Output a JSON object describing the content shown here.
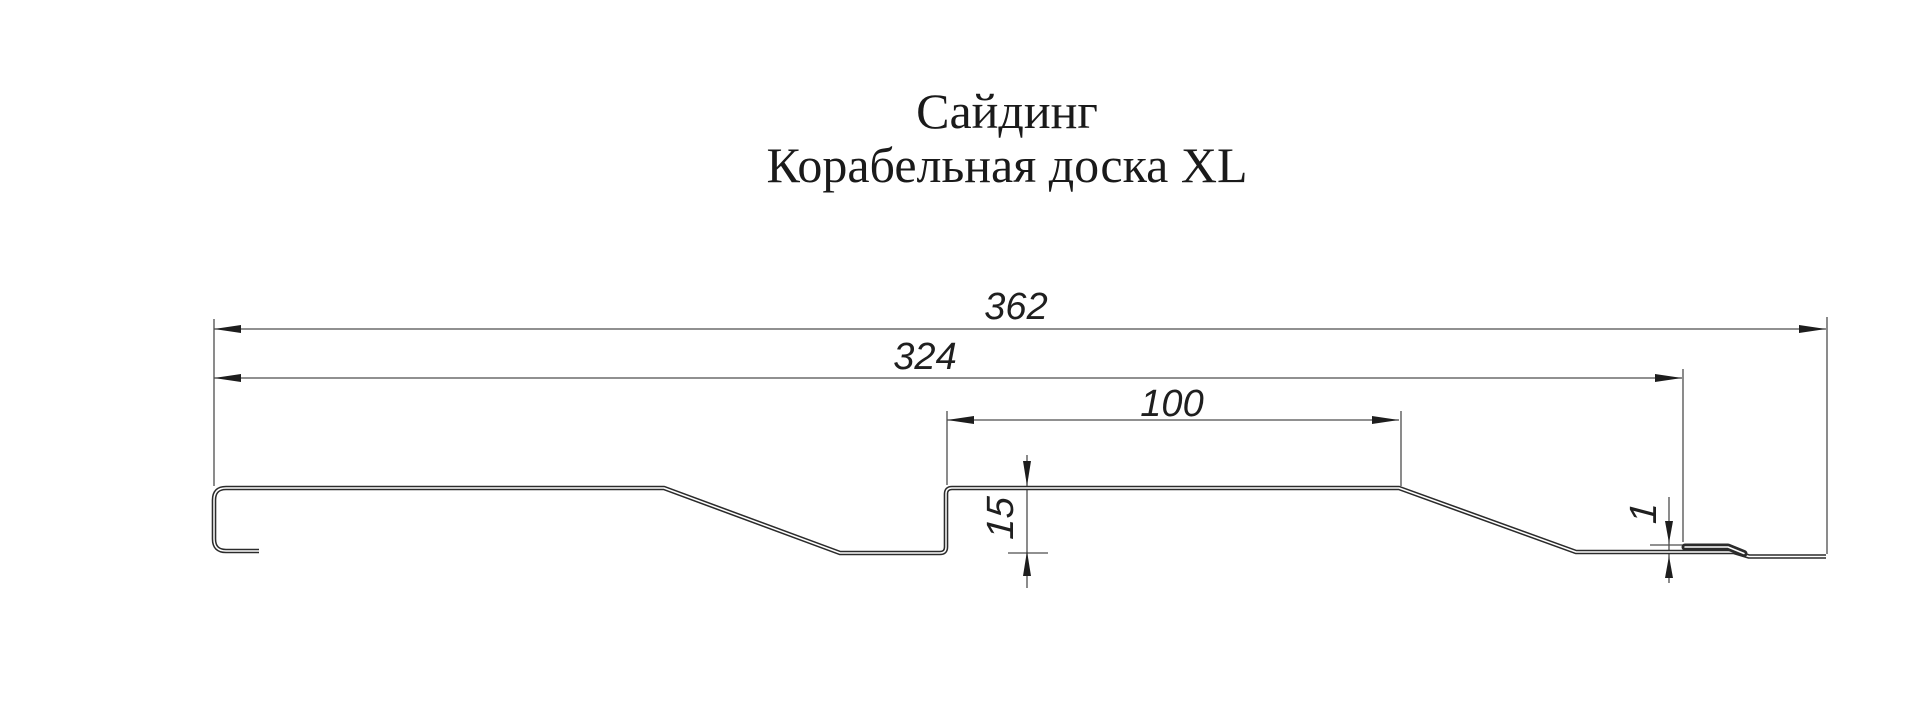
{
  "title": {
    "line1": "Сайдинг",
    "line2": "Корабельная доска XL"
  },
  "dimensions": {
    "overall_width": "362",
    "working_width": "324",
    "plank_width": "100",
    "profile_depth": "15",
    "seam_thickness": "1"
  },
  "colors": {
    "background": "#ffffff",
    "profile_line": "#2b2b2b",
    "thin_line": "#4d4d4d",
    "arrow": "#1d1d1d",
    "text": "#1a1a1a"
  }
}
